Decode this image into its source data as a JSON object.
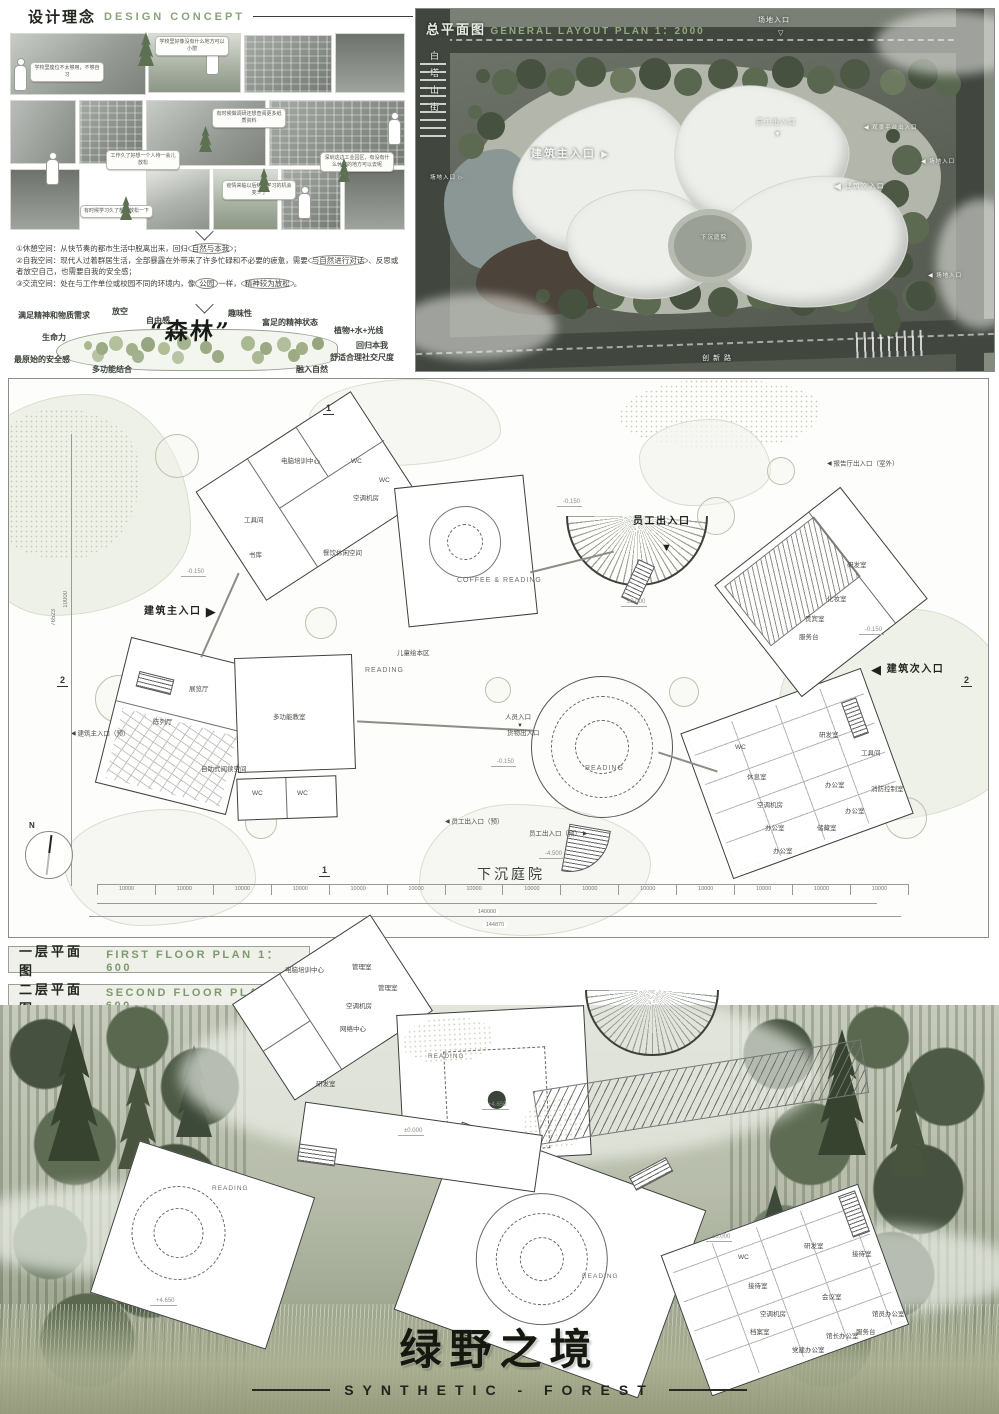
{
  "icons": {
    "tri_r": "▶",
    "tri_l": "◀",
    "tri_d": "▼",
    "tri_d_open": "▽",
    "tri_r_open": "▷"
  },
  "concept": {
    "title_zh": "设计理念",
    "title_en": "DESIGN CONCEPT",
    "bubbles": [
      "学校里座位不太够用，不够自习",
      "学校里好像没有什么地方可以小憩",
      "有时候做调研还想查阅更多纸质资料",
      "工作久了好想一个人待一会儿放松",
      "深圳这边工业园区，有没有什么休憩的地方可以去呢",
      "疫情来临以后结伴学习的机会变少了",
      "有时候学习久了想要放松一下"
    ],
    "points": {
      "p0": {
        "a": "①休憩空间：从快节奏的都市生活中脱离出来，回归",
        "b": "自然与本我",
        "c": "；"
      },
      "p1": {
        "a": "②自我空间：现代人过着群居生活，全部暴露在外带来了许多忙碌和不必要的疲惫，需要",
        "b": "与自然进行对话",
        "c": "、反思或者放空自己，也需要自我的安全感；"
      },
      "p2": {
        "a": "③交流空间：处在与工作单位或校园不同的环境内，像",
        "b": "公园",
        "c": "一样，",
        "d": "精神较为放松",
        "e": "。"
      }
    },
    "cloud": {
      "center": "“森林”",
      "words": [
        "满足精神和物质需求",
        "放空",
        "自由感",
        "趣味性",
        "富足的精神状态",
        "植物+水+光线",
        "生命力",
        "回归本我",
        "最原始的安全感",
        "多功能结合",
        "融入自然",
        "舒适合理社交尺度"
      ]
    }
  },
  "siteplan": {
    "title_zh": "总平面图",
    "title_en": "GENERAL LAYOUT PLAN 1：2000",
    "street_left": "白塔山街",
    "street_bottom": "创新路",
    "labels": {
      "site_entry": "场地入口",
      "main_entry": "建筑主入口",
      "staff_entry": "员工出入口",
      "view_platform": "观景平台出入口",
      "side_entry": "建筑次入口",
      "courtyard": "下沉庭院"
    }
  },
  "floor1": {
    "caption_zh": "一层平面图",
    "caption_en": "FIRST FLOOR PLAN 1：600",
    "entrances": {
      "main": "建筑主入口",
      "staff": "员工出入口",
      "side": "建筑次入口",
      "people": "人员入口",
      "goods": "货物出入口",
      "staff_res_l": "员工出入口（预）",
      "staff_res_r": "员工出入口（预）",
      "hall_out": "报告厅出入口（室外）",
      "main_res": "建筑主入口（预）"
    },
    "reading": {
      "coffee": "COFFEE & READING",
      "r1": "READING",
      "r2": "READING"
    },
    "rooms": [
      "电脑培训中心",
      "WC",
      "WC",
      "空调机房",
      "工具间",
      "书库",
      "餐饮休闲空间",
      "展览厅",
      "陈列厅",
      "多功能教室",
      "自助式阅读空间",
      "WC",
      "WC",
      "儿童绘本区",
      "研发室",
      "化妆室",
      "贵宾室",
      "服务台",
      "WC",
      "休息室",
      "空调机房",
      "办公室",
      "办公室",
      "研发室",
      "办公室",
      "储藏室",
      "办公室",
      "工具间",
      "消防控制室"
    ],
    "levels": {
      "a": "-0.150",
      "b": "-0.150",
      "c": "±0.000",
      "d": "-0.150",
      "e": "-0.150",
      "f": "-4.500"
    },
    "dims": {
      "seg": "10000",
      "total": "140000",
      "overall": "144870",
      "left": "76523",
      "left2": "10000"
    },
    "courtyard": "下沉庭院",
    "compass_n": "N",
    "sect1": "1",
    "sect2": "2"
  },
  "floor2": {
    "caption_zh": "二层平面图",
    "caption_en": "SECOND FLOOR PLAN 1：600",
    "reading": {
      "r1": "READING",
      "r2": "READING",
      "r3": "READING"
    },
    "rooms": [
      "电脑培训中心",
      "管理室",
      "管理室",
      "空调机房",
      "网络中心",
      "研发室",
      "WC",
      "接待室",
      "研发室",
      "空调机房",
      "档案室",
      "会议室",
      "馆长办公室",
      "党建办公室",
      "接待室",
      "馆员办公室",
      "服务台"
    ],
    "levels": {
      "a": "+4.650",
      "b": "±0.000",
      "c": "±0.000",
      "d": "+4.650"
    }
  },
  "footer": {
    "title_zh": "绿野之境",
    "title_en": "SYNTHETIC - FOREST"
  }
}
